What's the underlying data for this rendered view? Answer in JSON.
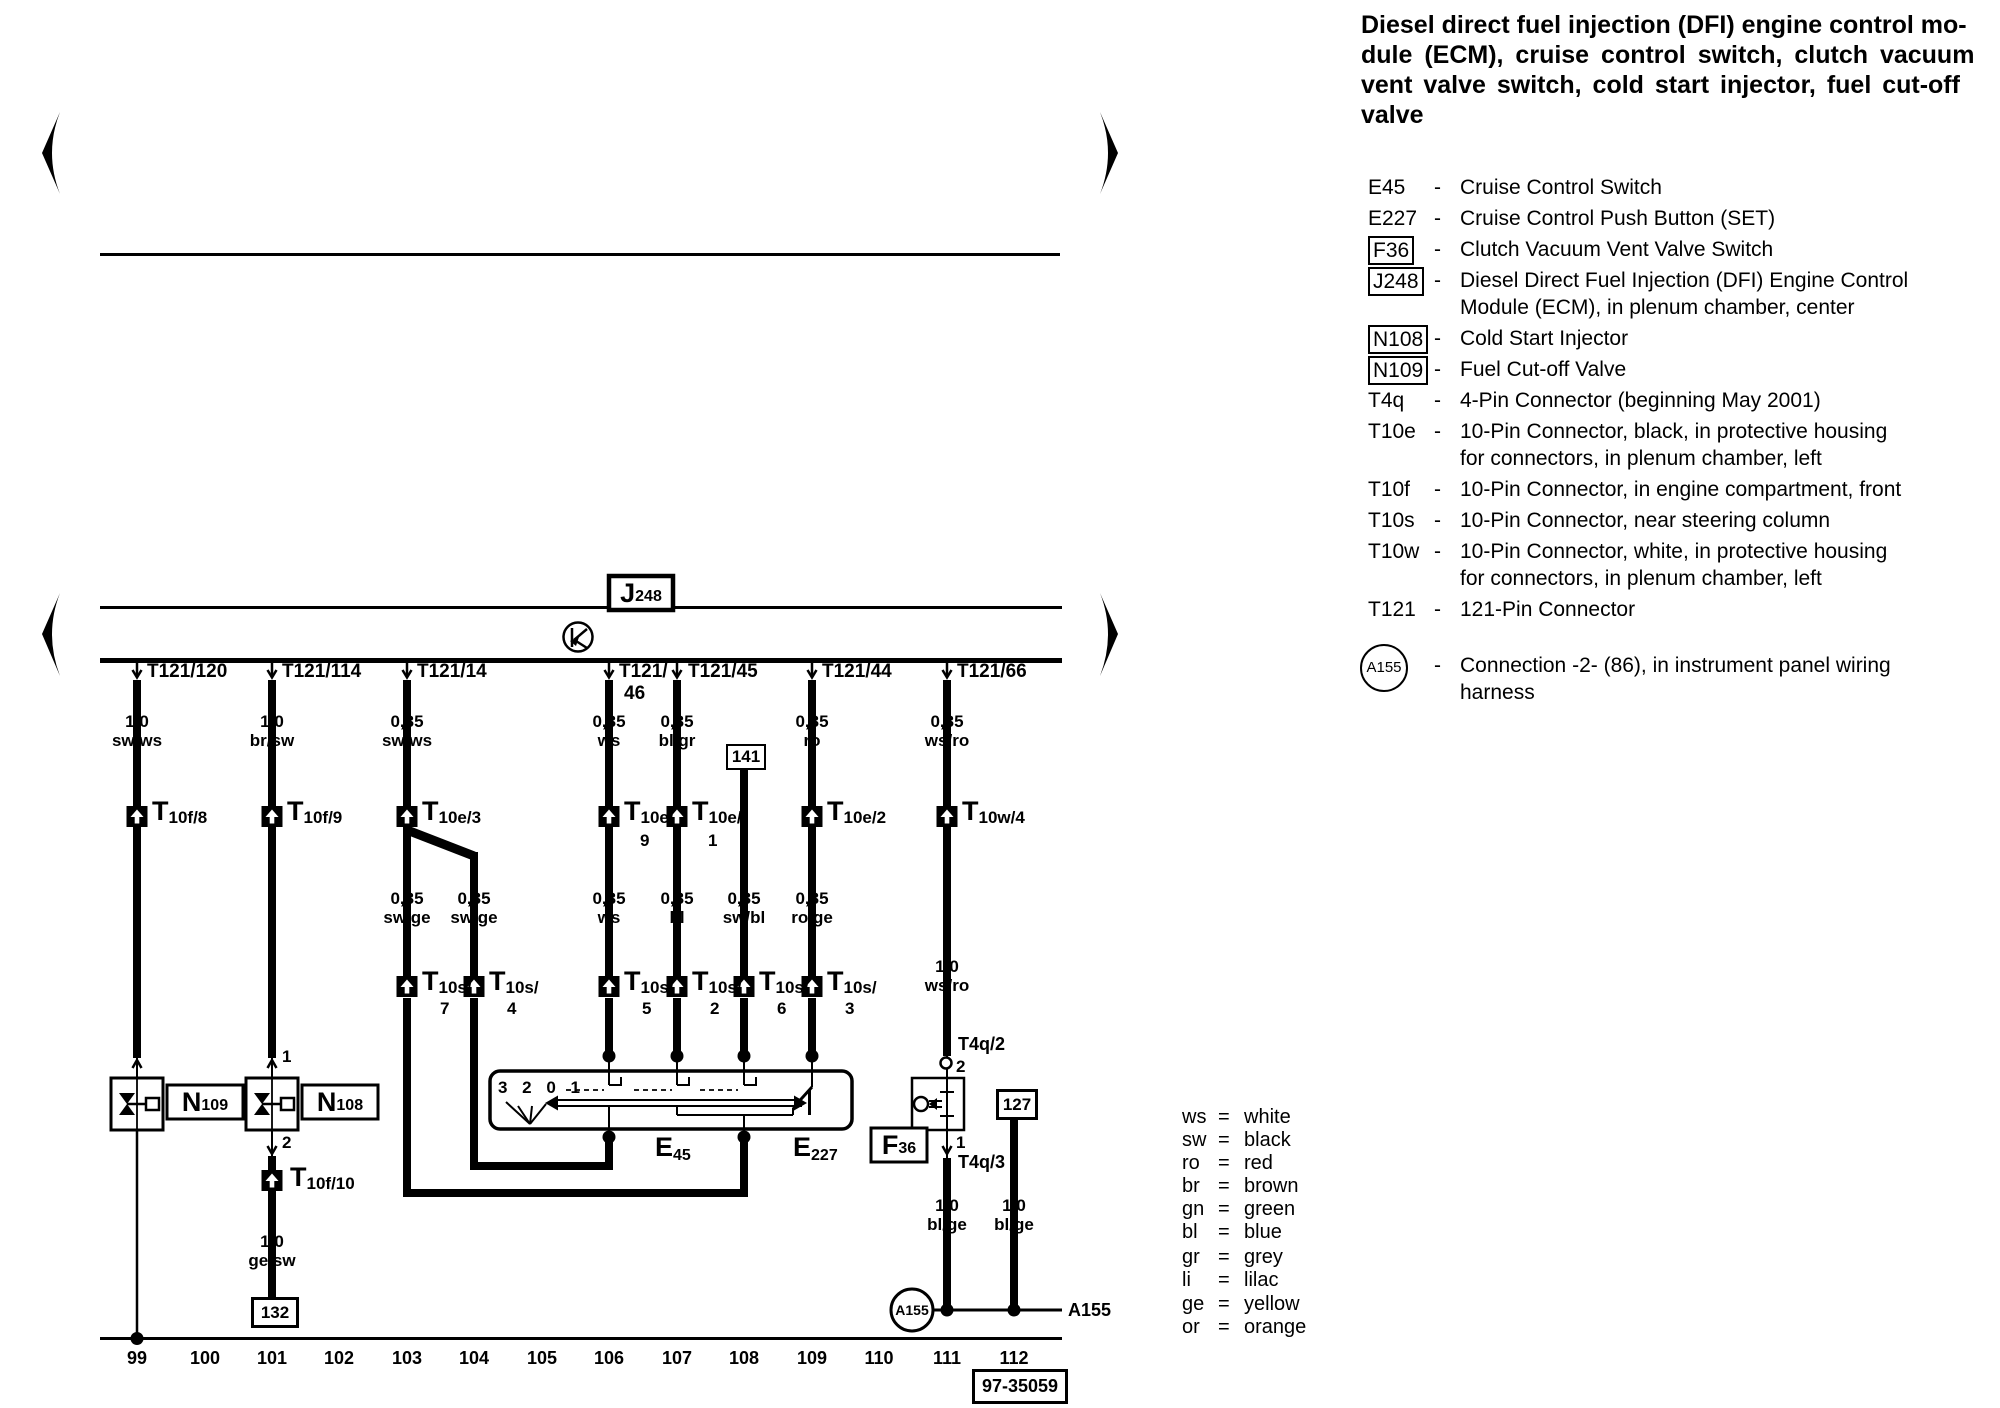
{
  "title": {
    "lines": [
      "Diesel direct fuel injection (DFI) engine control mo-",
      "dule (ECM), cruise control switch, clutch vacuum",
      "vent valve switch, cold start injector, fuel cut-off",
      "valve"
    ]
  },
  "legend": {
    "dash": "-",
    "items": [
      {
        "key": "E45",
        "style": "plain",
        "desc": [
          "Cruise Control Switch"
        ]
      },
      {
        "key": "E227",
        "style": "plain",
        "desc": [
          "Cruise Control Push Button (SET)"
        ]
      },
      {
        "key": "F36",
        "style": "box",
        "desc": [
          "Clutch Vacuum Vent Valve Switch"
        ]
      },
      {
        "key": "J248",
        "style": "box",
        "desc": [
          "Diesel Direct Fuel Injection (DFI) Engine Control",
          "Module (ECM), in plenum chamber, center"
        ]
      },
      {
        "key": "N108",
        "style": "box",
        "desc": [
          "Cold Start Injector"
        ]
      },
      {
        "key": "N109",
        "style": "box",
        "desc": [
          "Fuel Cut-off Valve"
        ]
      },
      {
        "key": "T4q",
        "style": "plain",
        "desc": [
          "4-Pin Connector (beginning May 2001)"
        ]
      },
      {
        "key": "T10e",
        "style": "plain",
        "desc": [
          "10-Pin Connector, black, in protective housing",
          "for connectors, in plenum chamber, left"
        ]
      },
      {
        "key": "T10f",
        "style": "plain",
        "desc": [
          "10-Pin Connector, in engine compartment, front"
        ]
      },
      {
        "key": "T10s",
        "style": "plain",
        "desc": [
          "10-Pin Connector, near steering column"
        ]
      },
      {
        "key": "T10w",
        "style": "plain",
        "desc": [
          "10-Pin Connector, white, in protective housing",
          "for connectors, in plenum chamber, left"
        ]
      },
      {
        "key": "T121",
        "style": "plain",
        "desc": [
          "121-Pin Connector"
        ]
      },
      {
        "key": "A155",
        "style": "circle",
        "desc": [
          "Connection -2- (86), in instrument panel wiring",
          "harness"
        ]
      }
    ]
  },
  "wire_colors": {
    "eq": "=",
    "rows": [
      {
        "abbr": "ws",
        "name": "white"
      },
      {
        "abbr": "sw",
        "name": "black"
      },
      {
        "abbr": "ro",
        "name": "red"
      },
      {
        "abbr": "br",
        "name": "brown"
      },
      {
        "abbr": "gn",
        "name": "green"
      },
      {
        "abbr": "bl",
        "name": "blue"
      },
      {
        "abbr": "gr",
        "name": "grey"
      },
      {
        "abbr": "li",
        "name": "lilac"
      },
      {
        "abbr": "ge",
        "name": "yellow"
      },
      {
        "abbr": "or",
        "name": "orange"
      }
    ]
  },
  "diagram": {
    "ecm": {
      "main": "J",
      "sub": "248"
    },
    "pins": {
      "p1": "T121/120",
      "p2": "T121/114",
      "p3": "T121/14",
      "p4a": "T121/",
      "p4b": "46",
      "p5": "T121/45",
      "p6": "T121/44",
      "p7": "T121/66"
    },
    "wires": {
      "w1": [
        "1,0",
        "sw/ws"
      ],
      "w2": [
        "1,0",
        "br/sw"
      ],
      "w3": [
        "0,35",
        "sw/ws"
      ],
      "w4": [
        "0,35",
        "ws"
      ],
      "w5": [
        "0,35",
        "bl/gr"
      ],
      "w6": [
        "0,35",
        "ro"
      ],
      "w7": [
        "0,35",
        "ws/ro"
      ],
      "w8": [
        "0,35",
        "sw/ge"
      ],
      "w9": [
        "0,35",
        "sw/ge"
      ],
      "w10": [
        "0,35",
        "ws"
      ],
      "w11": [
        "0,35",
        "bl"
      ],
      "w12": [
        "0,35",
        "sw/bl"
      ],
      "w13": [
        "0,35",
        "ro/ge"
      ],
      "w14": [
        "1,0",
        "ws/ro"
      ],
      "w15": [
        "1,0",
        "bl/ge"
      ],
      "w16": [
        "1,0",
        "bl/ge"
      ],
      "w17": [
        "1,0",
        "ge/sw"
      ]
    },
    "connectors": {
      "c1": {
        "t": "T",
        "s": "10f/8"
      },
      "c2": {
        "t": "T",
        "s": "10f/9"
      },
      "c3": {
        "t": "T",
        "s": "10e/3"
      },
      "c4": {
        "t": "T",
        "s": "10e/",
        "n": "9"
      },
      "c5": {
        "t": "T",
        "s": "10e/",
        "n": "1"
      },
      "c6": {
        "t": "T",
        "s": "10e/2"
      },
      "c7": {
        "t": "T",
        "s": "10w/4"
      },
      "s7": {
        "t": "T",
        "s": "10s/",
        "n": "7"
      },
      "s4": {
        "t": "T",
        "s": "10s/",
        "n": "4"
      },
      "s5": {
        "t": "T",
        "s": "10s/",
        "n": "5"
      },
      "s2": {
        "t": "T",
        "s": "10s/",
        "n": "2"
      },
      "s6": {
        "t": "T",
        "s": "10s/",
        "n": "6"
      },
      "s3": {
        "t": "T",
        "s": "10s/",
        "n": "3"
      },
      "f10": {
        "t": "T",
        "s": "10f/10"
      }
    },
    "t4q": {
      "upper": "T4q/2",
      "upper_pin": "2",
      "lower": "T4q/3",
      "lower_pin": "1"
    },
    "n108_pins": {
      "top": "1",
      "bottom": "2"
    },
    "components": {
      "n109": {
        "main": "N",
        "sub": "109"
      },
      "n108": {
        "main": "N",
        "sub": "108"
      },
      "e45": {
        "main": "E",
        "sub": "45"
      },
      "e227": {
        "main": "E",
        "sub": "227"
      },
      "f36": {
        "main": "F",
        "sub": "36"
      },
      "positions": "3 2 0 1"
    },
    "refs": {
      "r141": "141",
      "r132": "132",
      "r127": "127",
      "code": "97-35059",
      "a155": "A155",
      "a155_lbl": "A155"
    },
    "tracks": [
      "99",
      "100",
      "101",
      "102",
      "103",
      "104",
      "105",
      "106",
      "107",
      "108",
      "109",
      "110",
      "111",
      "112"
    ]
  }
}
